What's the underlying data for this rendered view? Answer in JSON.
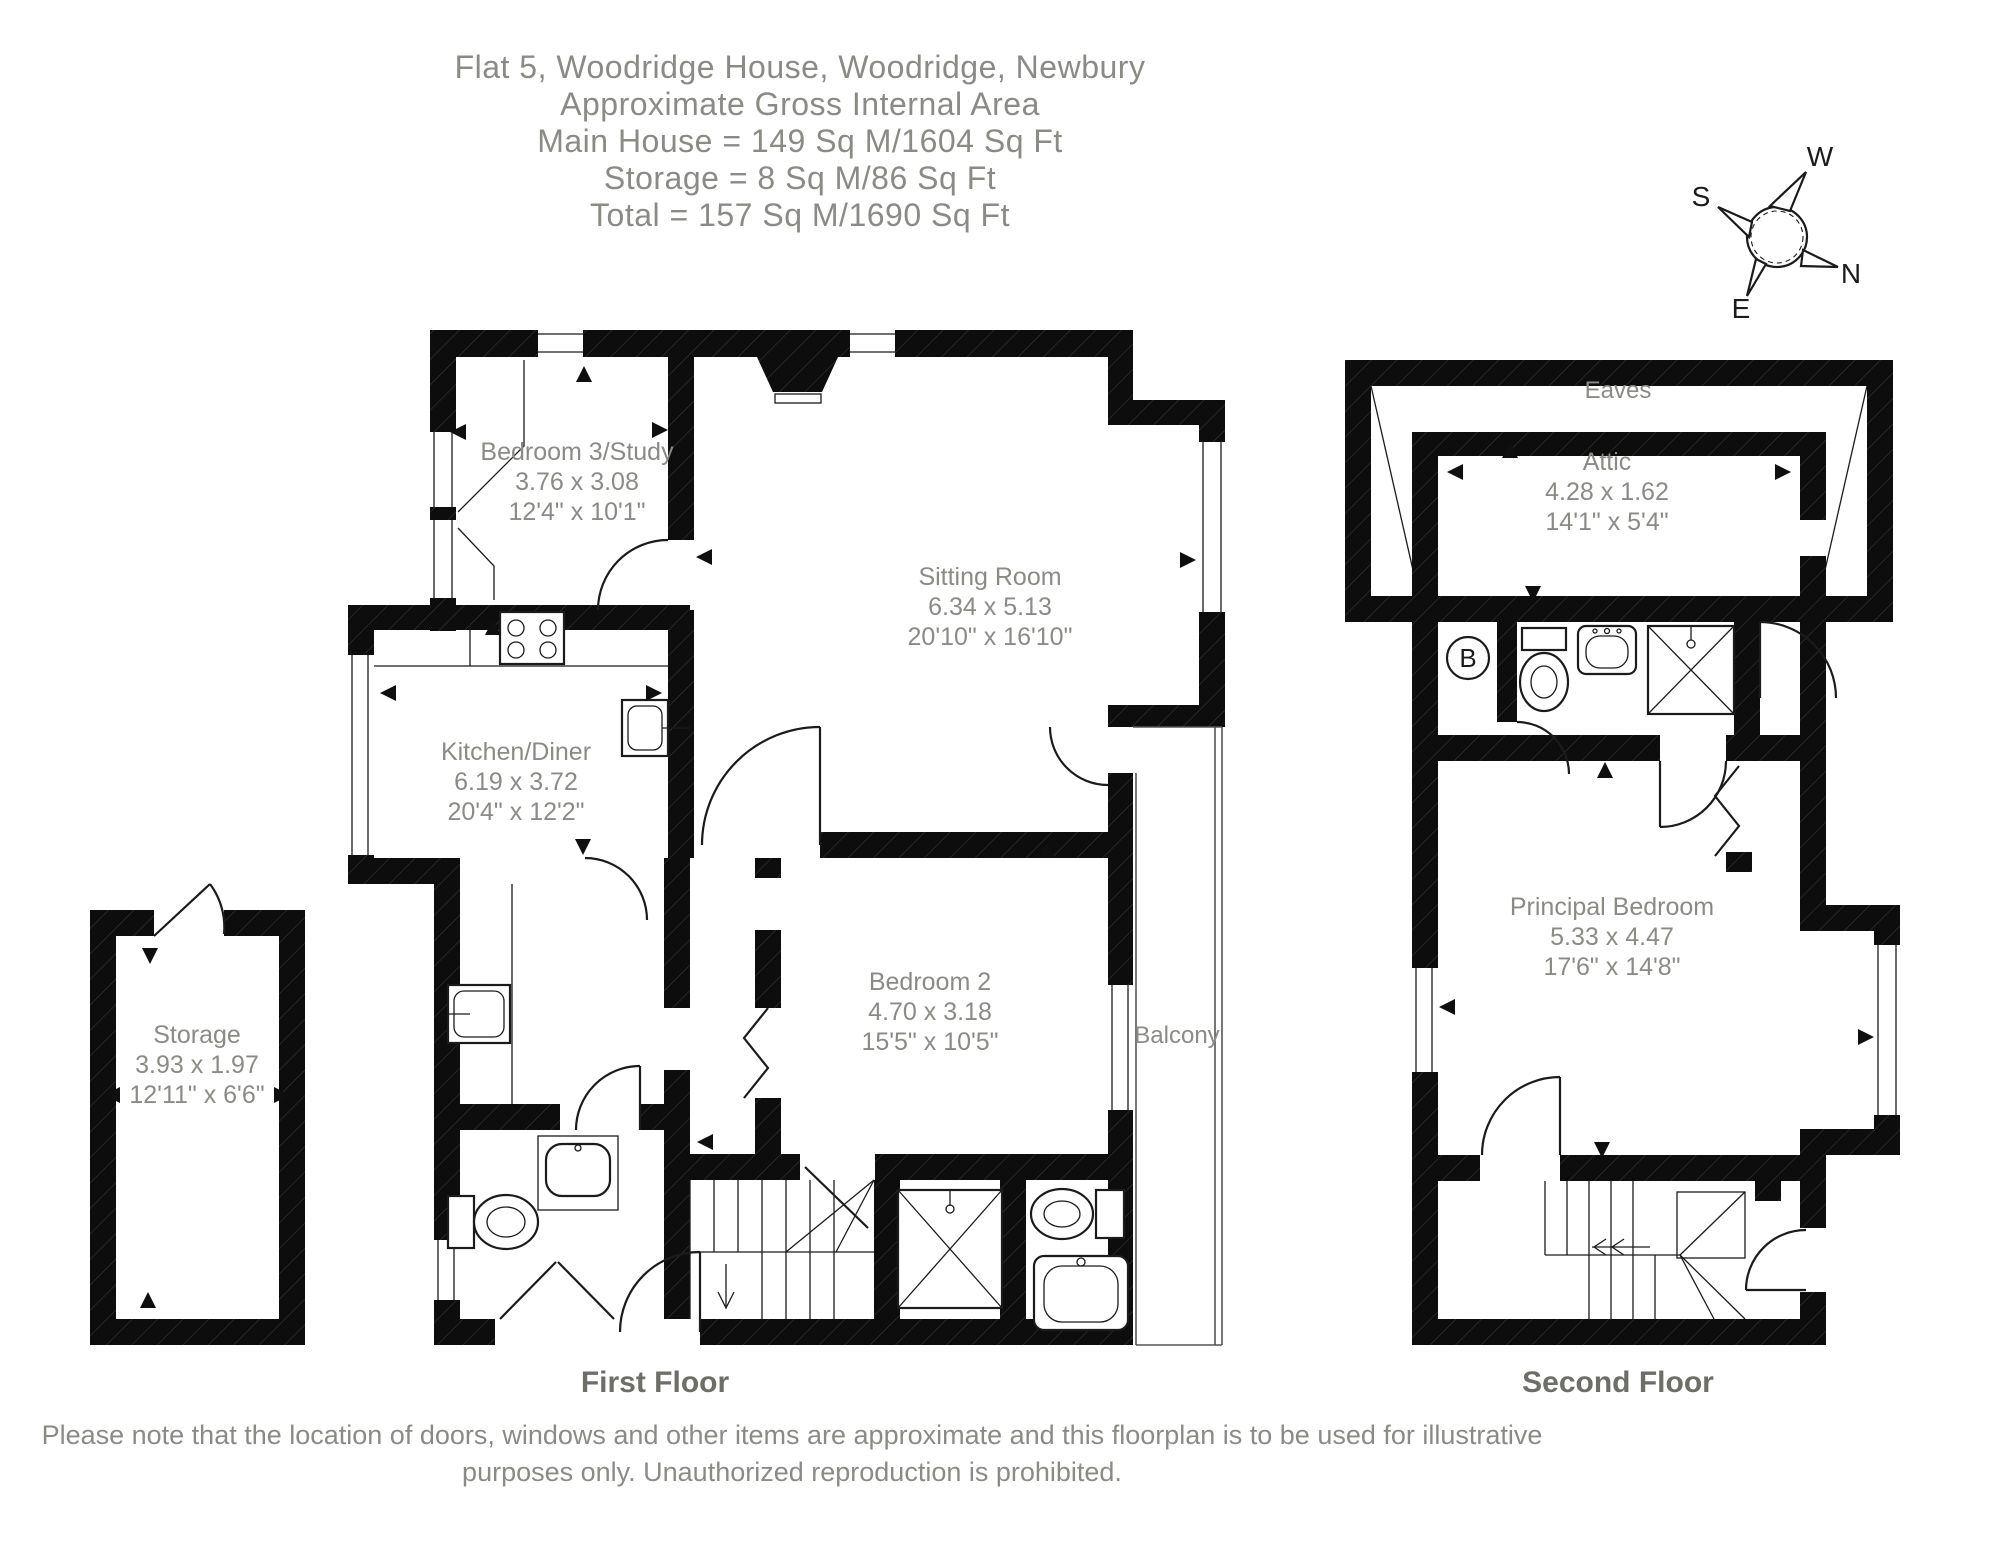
{
  "header": {
    "line1": "Flat 5, Woodridge House, Woodridge, Newbury",
    "line2": "Approximate Gross Internal Area",
    "line3": "Main House = 149 Sq M/1604 Sq Ft",
    "line4": "Storage = 8 Sq M/86 Sq Ft",
    "line5": "Total = 157 Sq M/1690 Sq Ft"
  },
  "compass": {
    "n": "N",
    "s": "S",
    "e": "E",
    "w": "W"
  },
  "floors": {
    "first": {
      "label": "First Floor"
    },
    "second": {
      "label": "Second Floor"
    }
  },
  "rooms": {
    "bedroom3": {
      "name": "Bedroom 3/Study",
      "metric": "3.76 x 3.08",
      "imperial": "12'4\" x 10'1\""
    },
    "sitting": {
      "name": "Sitting Room",
      "metric": "6.34 x 5.13",
      "imperial": "20'10\" x 16'10\""
    },
    "kitchen": {
      "name": "Kitchen/Diner",
      "metric": "6.19 x 3.72",
      "imperial": "20'4\" x 12'2\""
    },
    "storage": {
      "name": "Storage",
      "metric": "3.93 x 1.97",
      "imperial": "12'11\" x 6'6\""
    },
    "bedroom2": {
      "name": "Bedroom 2",
      "metric": "4.70 x 3.18",
      "imperial": "15'5\" x 10'5\""
    },
    "balcony": {
      "name": "Balcony"
    },
    "eaves": {
      "name": "Eaves"
    },
    "attic": {
      "name": "Attic",
      "metric": "4.28 x 1.62",
      "imperial": "14'1\" x 5'4\""
    },
    "principal": {
      "name": "Principal Bedroom",
      "metric": "5.33 x 4.47",
      "imperial": "17'6\" x 14'8\""
    }
  },
  "annotations": {
    "boiler": "B"
  },
  "footer": {
    "line1": "Please note that the location of doors, windows and other items are approximate and this floorplan is to be used for illustrative",
    "line2": "purposes only. Unauthorized reproduction is prohibited."
  },
  "colors": {
    "text_gray": "#8b8b86",
    "floor_label": "#6e6e69",
    "wall": "#0d0d0d"
  }
}
